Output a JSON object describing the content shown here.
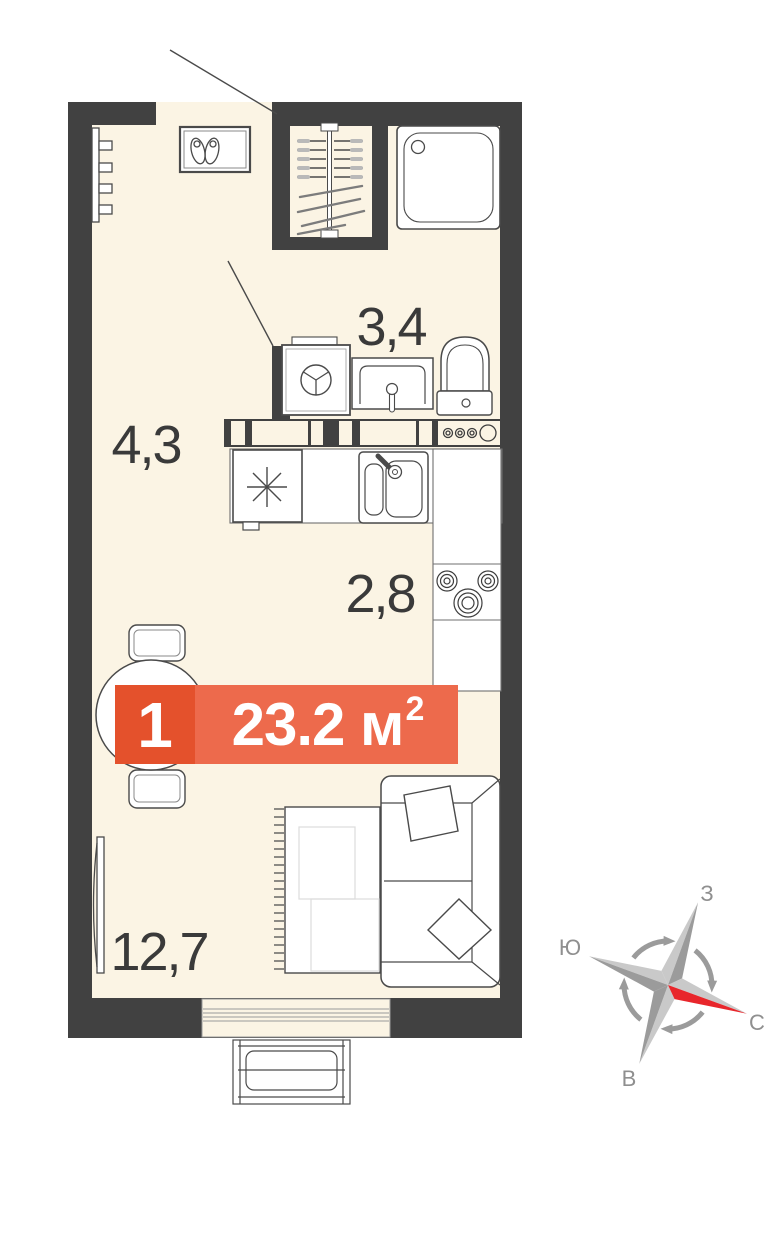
{
  "rooms": [
    {
      "name": "bathroom",
      "area": "3,4"
    },
    {
      "name": "hallway",
      "area": "4,3"
    },
    {
      "name": "kitchen",
      "area": "2,8"
    },
    {
      "name": "living-room",
      "area": "12,7"
    }
  ],
  "badge": {
    "rooms_count": "1",
    "area_text": "23.2 м",
    "area_superscript": "2"
  },
  "compass": {
    "north": "С",
    "south": "Ю",
    "west": "З",
    "east": "В"
  },
  "colors": {
    "wall": "#414141",
    "floor": "#fbf4e4",
    "badge_dark": "#e4512c",
    "badge_light": "#ed6a4c",
    "compass_red": "#e8262b",
    "label_text": "#3a3a3a",
    "compass_gray": "#9b9b9b"
  }
}
